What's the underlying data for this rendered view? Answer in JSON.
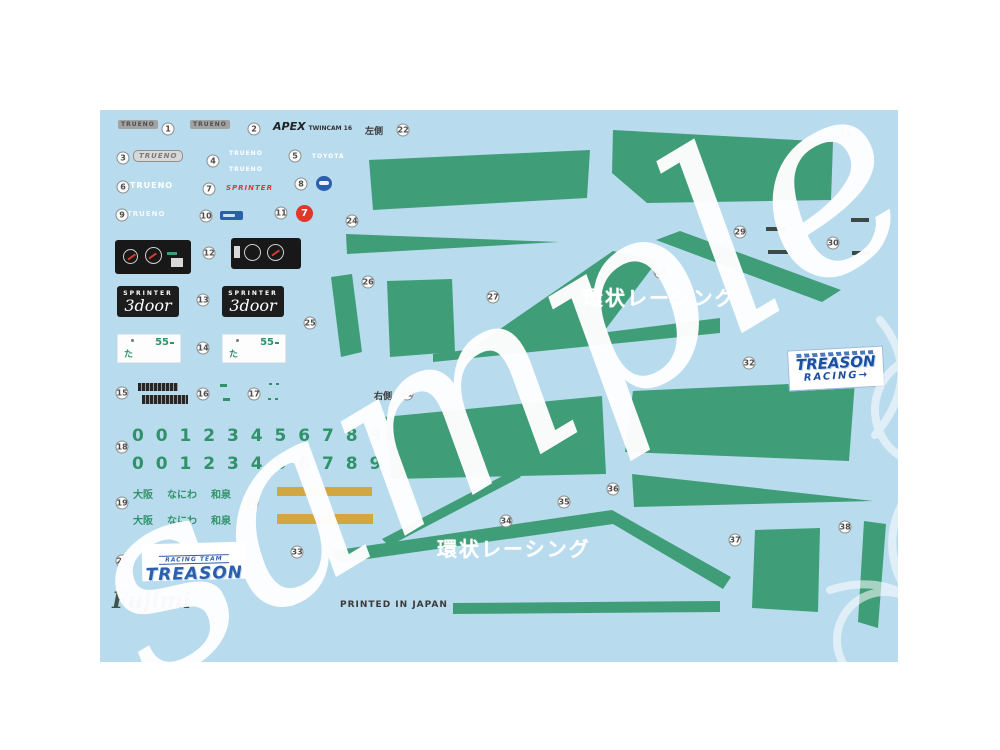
{
  "watermark": {
    "text": "sample"
  },
  "footer": {
    "brand": "Fujimi",
    "printed": "PRINTED IN JAPAN"
  },
  "labels": {
    "left_side": "左側",
    "right_side": "右側"
  },
  "decals": {
    "trueno": "TRUENO",
    "apex": "APEX",
    "apex_sub": "TWINCAM 16",
    "toyota": "TOYOTA",
    "sprinter": "SPRINTER",
    "seven": "7",
    "model_badge": {
      "top": "SPRINTER",
      "bottom": "3door"
    },
    "plate": {
      "number": "55",
      "kana": "た"
    },
    "digits_row": "0 0 1 2 3 4 5 6 7 8 9",
    "regions": {
      "a": "大阪",
      "b": "なにわ",
      "c": "和泉"
    },
    "team_logo": {
      "top": "RACING TEAM",
      "name": "TREASON"
    },
    "treason_racing": {
      "line1": "TREASON",
      "line2": "RACING→"
    },
    "kanjo_racing": "環状レーシング"
  },
  "colors": {
    "sheet": "#b9dbee",
    "green": "#3f9e78",
    "digit_green": "#2f9268",
    "gold": "#d2a640",
    "blue": "#2b5fac",
    "red": "#e0372b"
  },
  "callouts": [
    "1",
    "2",
    "3",
    "4",
    "5",
    "6",
    "7",
    "8",
    "9",
    "10",
    "11",
    "12",
    "13",
    "14",
    "15",
    "16",
    "17",
    "18",
    "19",
    "20",
    "21",
    "22",
    "23",
    "24",
    "25",
    "26",
    "27",
    "28",
    "29",
    "30",
    "31",
    "32",
    "33",
    "34",
    "35",
    "36",
    "37",
    "38"
  ]
}
